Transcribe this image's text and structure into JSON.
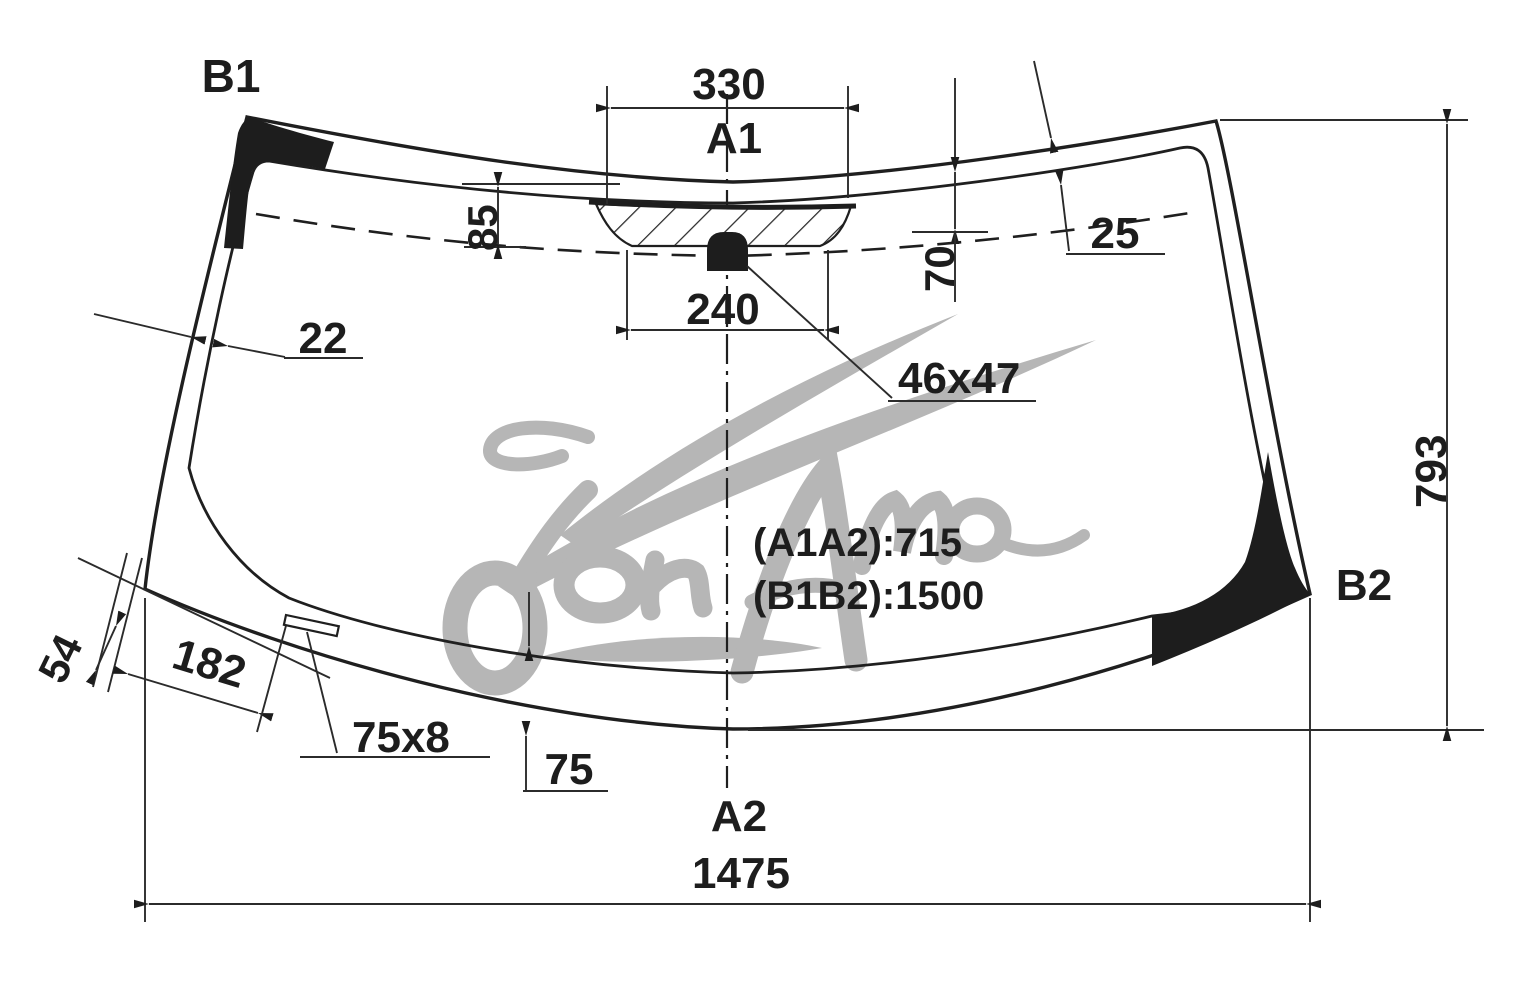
{
  "drawing": {
    "type": "windshield-glass-dimension-drawing",
    "background": "#ffffff"
  },
  "colors": {
    "ink": "#1d1d1d",
    "dimline": "#2b2b2b",
    "watermark": "#b6b6b6"
  },
  "labels": {
    "b1": "B1",
    "a1": "A1",
    "a2": "A2",
    "b2": "B2"
  },
  "dimensions": {
    "frit_top_width": "330",
    "frit_band_height": "85",
    "top_right_edge_offset": "25",
    "mount_drop": "70",
    "frit_bottom_width": "240",
    "mount_size": "46x47",
    "left_edge_width": "22",
    "glass_height": "793",
    "corner_offset": "54",
    "strip_distance": "182",
    "strip_size": "75x8",
    "bottom_band_height": "75",
    "glass_width": "1475"
  },
  "notes": {
    "a1a2": "(A1A2):715",
    "b1b2": "(B1B2):1500"
  },
  "watermark": {
    "text": "Дон Авто"
  }
}
